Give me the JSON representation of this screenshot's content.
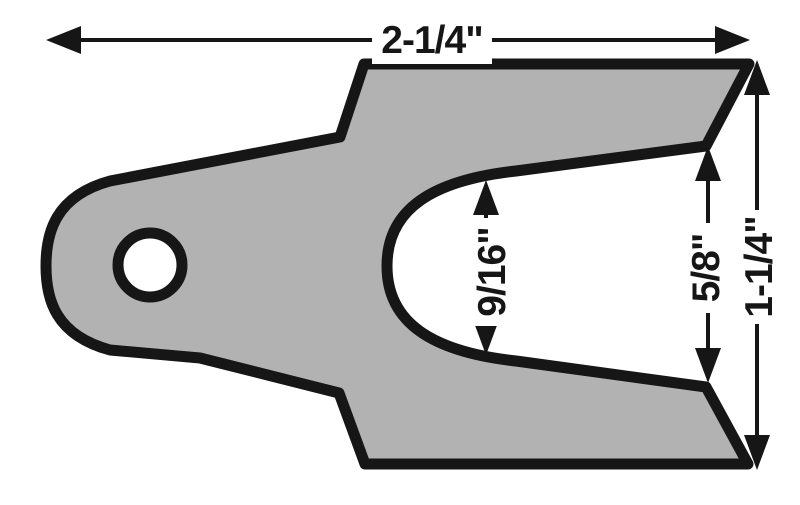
{
  "figure": {
    "title": "slotted shim technical drawing",
    "background_color": "#ffffff",
    "part": {
      "name": "slotted-shim-plate",
      "fill_color": "#b2b2b2",
      "outline_color": "#161616"
    },
    "dimensions": {
      "overall_width": {
        "label": "2-1/4\""
      },
      "slot_width": {
        "label": "9/16\""
      },
      "opening_width": {
        "label": "5/8\""
      },
      "overall_height": {
        "label": "1-1/4\""
      }
    }
  }
}
